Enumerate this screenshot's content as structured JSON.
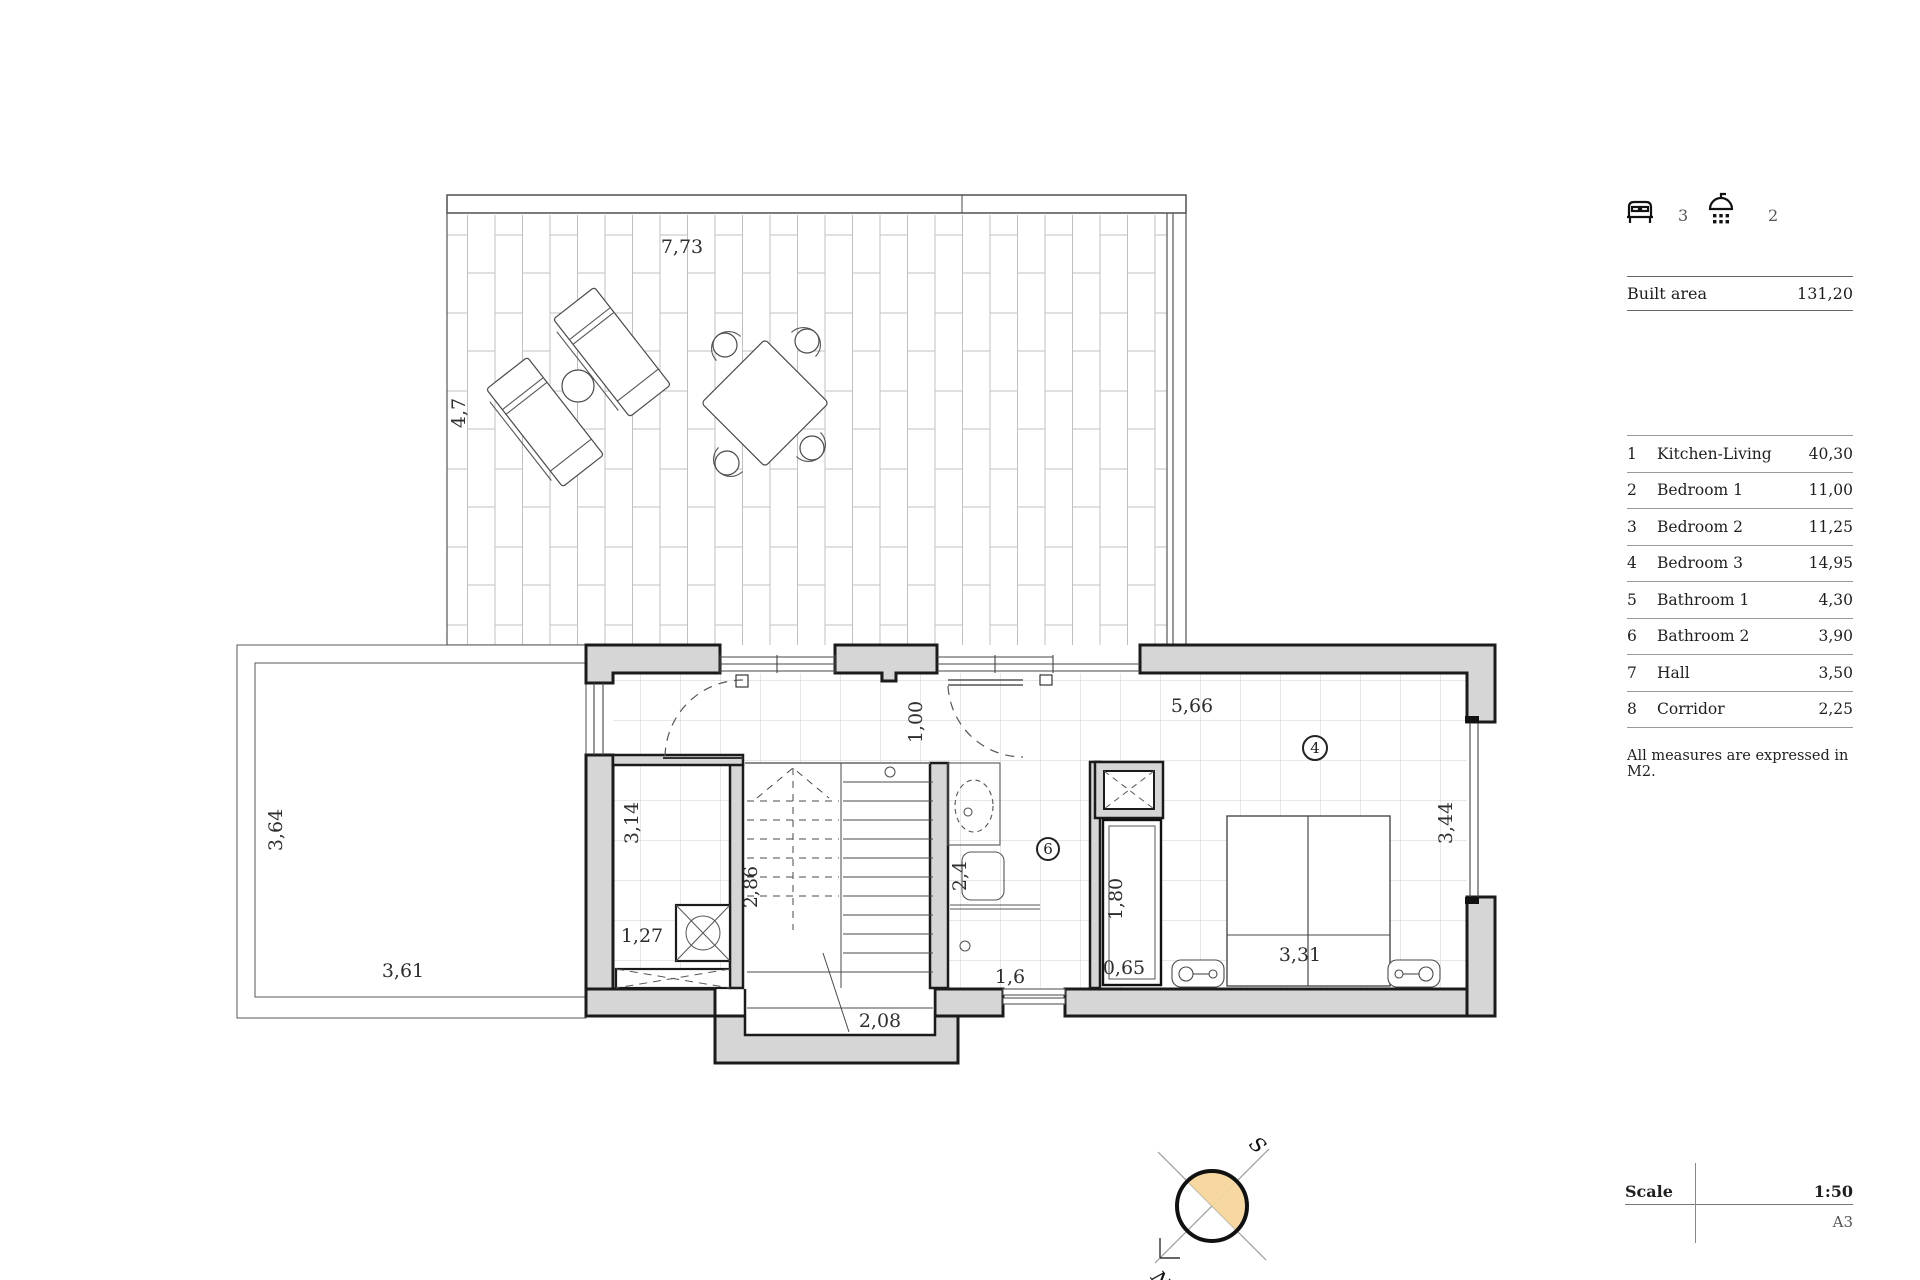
{
  "panel": {
    "beds_count": "3",
    "showers_count": "2",
    "built_area": {
      "label": "Built area",
      "value": "131,20"
    },
    "rooms": [
      {
        "num": "1",
        "name": "Kitchen-Living",
        "area": "40,30"
      },
      {
        "num": "2",
        "name": "Bedroom 1",
        "area": "11,00"
      },
      {
        "num": "3",
        "name": "Bedroom 2",
        "area": "11,25"
      },
      {
        "num": "4",
        "name": "Bedroom 3",
        "area": "14,95"
      },
      {
        "num": "5",
        "name": "Bathroom 1",
        "area": "4,30"
      },
      {
        "num": "6",
        "name": "Bathroom 2",
        "area": "3,90"
      },
      {
        "num": "7",
        "name": "Hall",
        "area": "3,50"
      },
      {
        "num": "8",
        "name": "Corridor",
        "area": "2,25"
      }
    ],
    "note": "All measures are expressed in M2.",
    "scale_label": "Scale",
    "scale_value": "1:50",
    "sheet": "A3"
  },
  "plan": {
    "dims": {
      "terrace_w": "7,73",
      "terrace_d": "4,7",
      "patio_d": "3,64",
      "patio_w": "3,61",
      "hall_d": "3,14",
      "closet_w": "1,27",
      "stair_d": "2,86",
      "stair_w": "2,08",
      "door_w": "1,00",
      "corridor_w": "5,66",
      "wc_d": "2,4",
      "shower_w": "1,6",
      "wardrobe_d": "1,80",
      "wardrobe_w": "0,65",
      "bed_w": "3,31",
      "bedroom_d": "3,44"
    },
    "markers": {
      "bedroom3": "4",
      "bathroom2": "6"
    },
    "compass": {
      "north": "N",
      "south": "S"
    },
    "colors": {
      "wall_fill": "#d6d6d6",
      "outline": "#1b1b1b",
      "compass_fill": "#f7d8a2"
    }
  }
}
